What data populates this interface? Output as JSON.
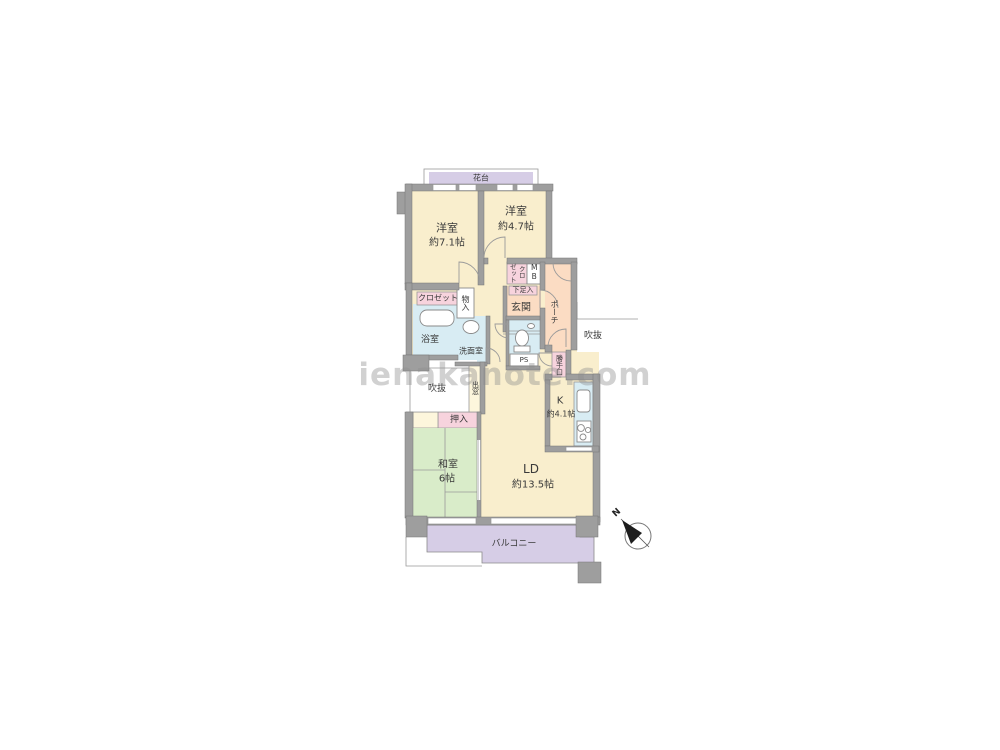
{
  "watermark": "ienakanote.com",
  "compass": {
    "label": "N"
  },
  "labels": {
    "flower_stand": "花台",
    "western1_name": "洋室",
    "western1_size": "約7.1帖",
    "western2_name": "洋室",
    "western2_size": "約4.7帖",
    "closet": "クロゼット",
    "storage": "物入",
    "closet_col_left": "ゼット",
    "closet_col_right": "クロ",
    "meter_box": "MB",
    "shoe_cabinet": "下足入",
    "entrance": "玄関",
    "porch": "ポーチ",
    "bathroom": "浴室",
    "washroom": "洗面室",
    "pipe_space": "PS",
    "void_right": "吹抜",
    "void_left": "吹抜",
    "bay_window": "出窓",
    "back_door": "勝手口",
    "kitchen_name": "K",
    "kitchen_size": "約4.1帖",
    "living_name": "LD",
    "living_size": "約13.5帖",
    "japanese_name": "和室",
    "japanese_size": "6帖",
    "futon_closet": "押入",
    "balcony": "バルコニー"
  },
  "colors": {
    "wall": "#9e9e9e",
    "room_cream": "#f9eecd",
    "entry_peach": "#fbdcc3",
    "tatami_green": "#d9ecc9",
    "wet_blue": "#d8ecf3",
    "closet_pink": "#f7d3dd",
    "balcony_lavender": "#d6cde6"
  }
}
